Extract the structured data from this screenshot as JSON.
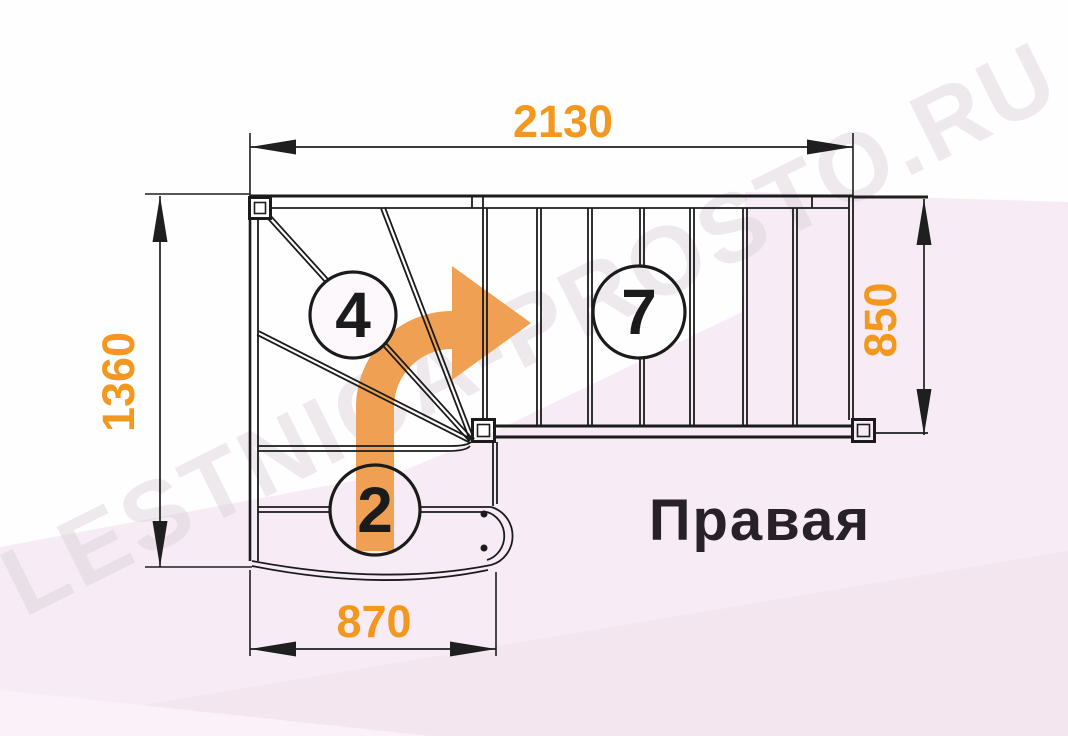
{
  "diagram": {
    "type": "staircase-floor-plan",
    "title": "Правая",
    "watermark": "LESTNICA-PROSTO.RU",
    "dimensions": {
      "top": "2130",
      "left": "1360",
      "right": "850",
      "bottom": "870"
    },
    "step_counts": {
      "lower_flight": "2",
      "winder_turn": "4",
      "upper_flight": "7"
    },
    "colors": {
      "dimension_text": "#F2981F",
      "direction_arrow": "#EFA052",
      "line": "#1B1B1B",
      "background_pink": "#F7ECF5"
    }
  }
}
